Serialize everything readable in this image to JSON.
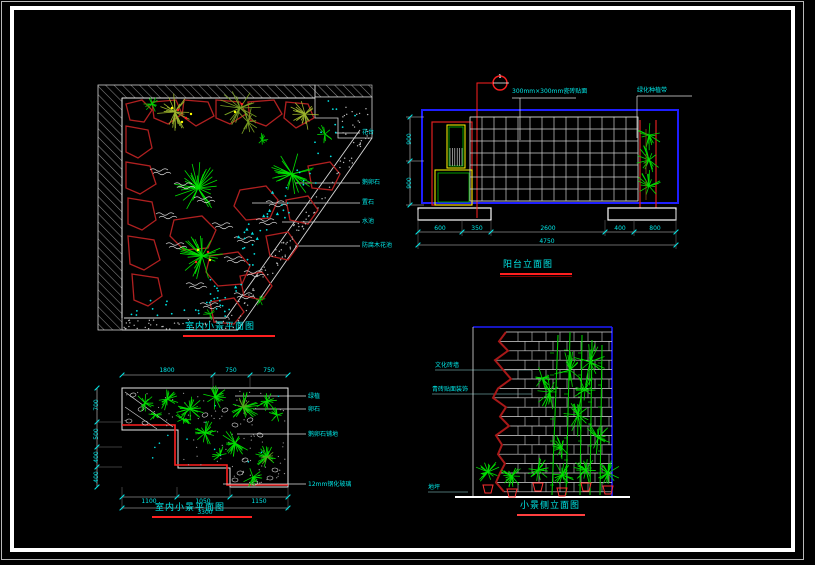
{
  "colors": {
    "cyan": "#00e8e8",
    "red": "#ff2020",
    "dark_red": "#b02020",
    "green": "#00e000",
    "blue": "#1e1eff",
    "yellow": "#ffff00",
    "white": "#ffffff",
    "hatch_gray": "#8a8a8a",
    "background": "#000000"
  },
  "plan_top_left": {
    "title": "室内小景平面图",
    "labels": [
      "花台",
      "鹅卵石",
      "置石",
      "水池",
      "防腐木花池"
    ]
  },
  "elevation_top_right": {
    "title": "阳台立面图",
    "section_no": "1",
    "callout_tile": "300mm×300mm瓷砖贴面",
    "callout_plant": "绿化种植带",
    "dims_bottom": [
      "600",
      "350",
      "2600",
      "400",
      "800"
    ],
    "dim_total": "4750",
    "dims_left": [
      "900",
      "900"
    ]
  },
  "plan_bottom_left": {
    "title": "室内小景平面图",
    "labels": [
      "绿植",
      "卵石",
      "鹅卵石铺地",
      "12mm钢化玻璃"
    ],
    "dims_top": [
      "1800",
      "750",
      "750"
    ],
    "dims_left": [
      "700",
      "500",
      "400",
      "400"
    ],
    "dims_bottom": [
      "1100",
      "1050",
      "1150"
    ],
    "dim_total": "3300"
  },
  "detail_bottom_right": {
    "title": "小景侧立面图",
    "labels": [
      "文化砖墙",
      "青砖贴面装饰",
      "地坪"
    ]
  }
}
